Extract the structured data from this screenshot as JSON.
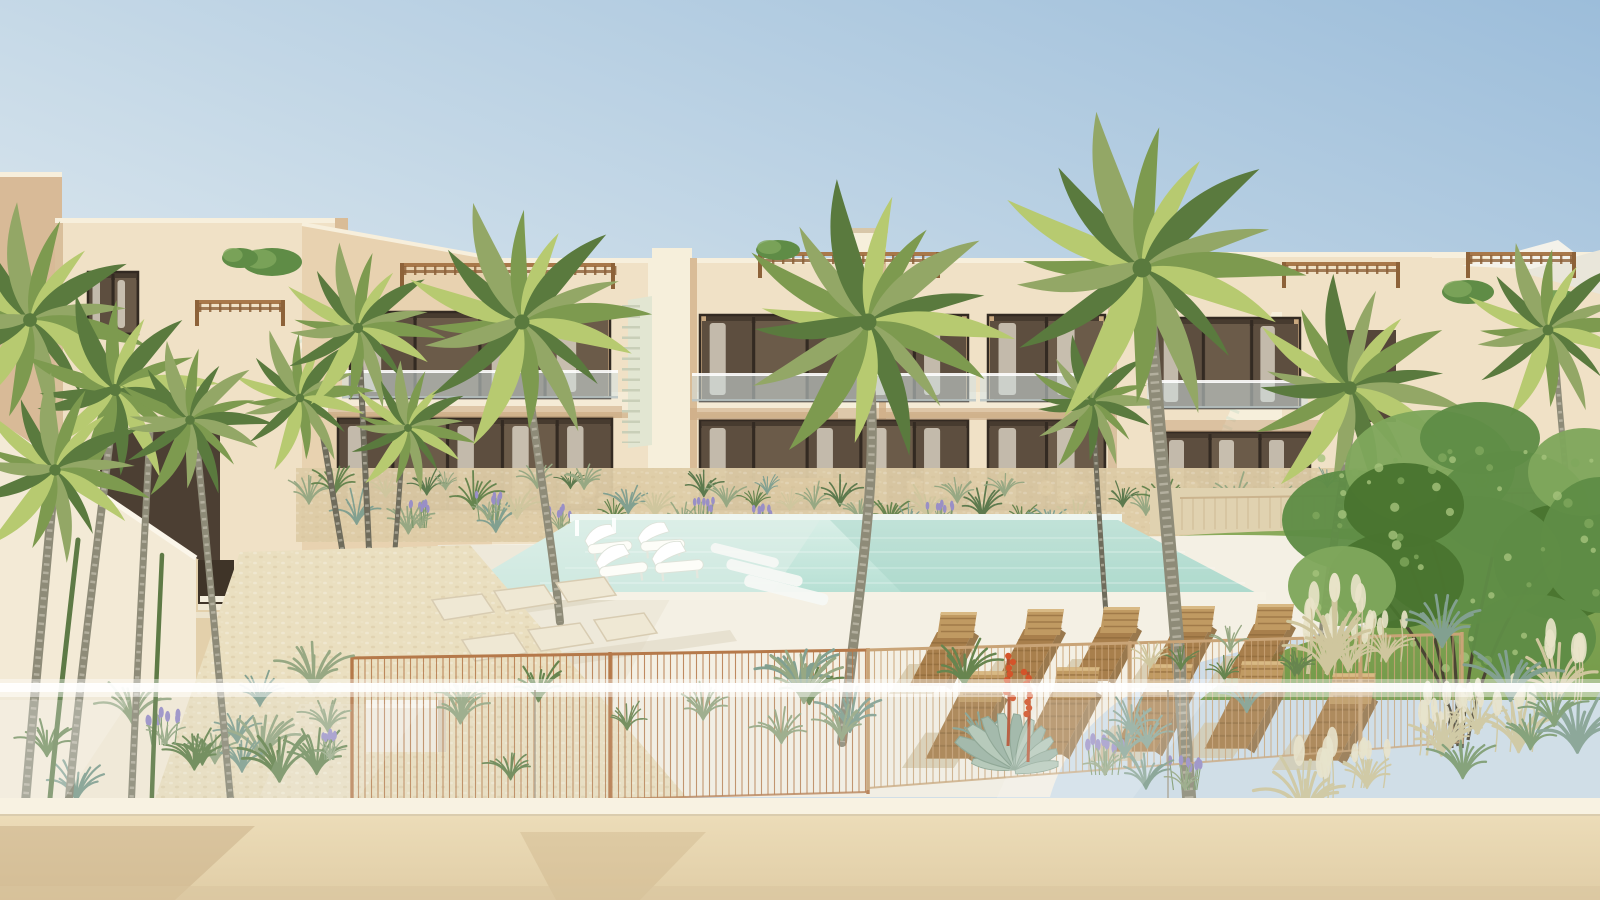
{
  "scene": {
    "kind": "photorealistic architectural rendering",
    "subject": "two-storey beige apartment complex with communal pool, sun loungers, palm trees and mediterranean garden, viewed from a balcony with glass balustrade",
    "sky": "clear blue, paler toward left and horizon",
    "no_visible_text": true
  },
  "palette": {
    "skyPaleBL": "#edf2f4",
    "skyMid": "#c9dbe8",
    "skyBlueTR": "#9cbdda",
    "wallLit": "#f0e1c6",
    "wallWarm": "#e8d2b0",
    "wallShadow": "#d9bc97",
    "wallDeep": "#c9a87f",
    "parapetLight": "#f7efdc",
    "sideWall": "#d8ba97",
    "recessDark": "#5d4e3f",
    "paneA": "#6b5b49",
    "paneB": "#5d4e3f",
    "frameDark": "#332a22",
    "curtain": "#eae4d6",
    "soffit": "#caa781",
    "slabLight": "#f5ebd6",
    "slabShadow": "#d2b58e",
    "stairPale": "#e2e6d2",
    "stairBeige": "#ecd9b2",
    "stairWhite": "#f6efdb",
    "pergola": "#a8784a",
    "pergolaDark": "#8d6239",
    "sail": "#f4f2ea",
    "poolFar": "#eef6f1",
    "poolLight": "#d9efe7",
    "poolMain": "#b5dfd3",
    "poolDeep": "#a4d2c5",
    "deck": "#f4f0e4",
    "deckShade": "#e7e0cf",
    "poolRim": "#f6f2e6",
    "lawn": "#8cab5c",
    "lawnDark": "#739a49",
    "terraceGravel": "#e0d2b0",
    "gravel": "#ddcba6",
    "pathLight": "#eadfc0",
    "paver": "#efe8d4",
    "paverEdge": "#d8ccb2",
    "grassSage": "#97a883",
    "grassGreen": "#67854f",
    "grassBlue": "#82a090",
    "wheat": "#cfc69e",
    "plume": "#e9e3c9",
    "lavender": "#998fc6",
    "fenceCopper": "#b5794a",
    "fenceLight": "#c9a477",
    "backFence": "#c9b18b",
    "woodLounger": "#a87f4c",
    "woodDark": "#8f6a3c",
    "woodLight": "#c09a62",
    "loungerShadow": "#d2c5a7",
    "trunk": "#8e8b78",
    "trunkDark": "#6f6c5c",
    "trunkRing": "#d2cdbd",
    "trunkGreen": "#5e7a46",
    "palmMain": "#7d9a4f",
    "palmLight": "#b7ca70",
    "palmDark": "#5a7a3e",
    "palmSage": "#93a766",
    "treeGreen": "#5f8c46",
    "treeDark": "#49742f",
    "treeLight": "#7fa75c",
    "treeTrunk": "#4a4433",
    "agave": "#9db4a4",
    "agaveEdge": "#86a08d",
    "aloeRed": "#d4542a",
    "aloeStem": "#b3502f",
    "benchWhite": "#f2ece0",
    "glassWhite": "#ffffff",
    "glassJoint": "#a9a291",
    "frontWall": "#ecdcb8",
    "frontWallDark": "#e0cda6",
    "coping": "#f8f2e2",
    "copingShadow": "#c7b28c",
    "wallCastShadow": "#c8ae85"
  },
  "objects": {
    "buildings": {
      "count": 4,
      "storeys": 2,
      "features": [
        "recessed balconies",
        "glass balustrades",
        "roof pergolas",
        "external staircases"
      ]
    },
    "pool": {
      "shape": "rectangular with rounded deck lobe",
      "in_pool_loungers": 4,
      "entry_steps": 3
    },
    "sun_loungers": {
      "rows": 2,
      "per_row": 5,
      "material": "wood slats"
    },
    "palm_trees": {
      "count": 9
    },
    "leafy_tree": {
      "count": 1,
      "position": "right on lawn"
    },
    "garden": [
      "ornamental grasses",
      "lavender",
      "agave with red aloe blooms",
      "gravel path",
      "stepping pavers",
      "white bench"
    ],
    "foreground": [
      "metal pool fence",
      "glass balustrade",
      "beige parapet wall"
    ]
  }
}
